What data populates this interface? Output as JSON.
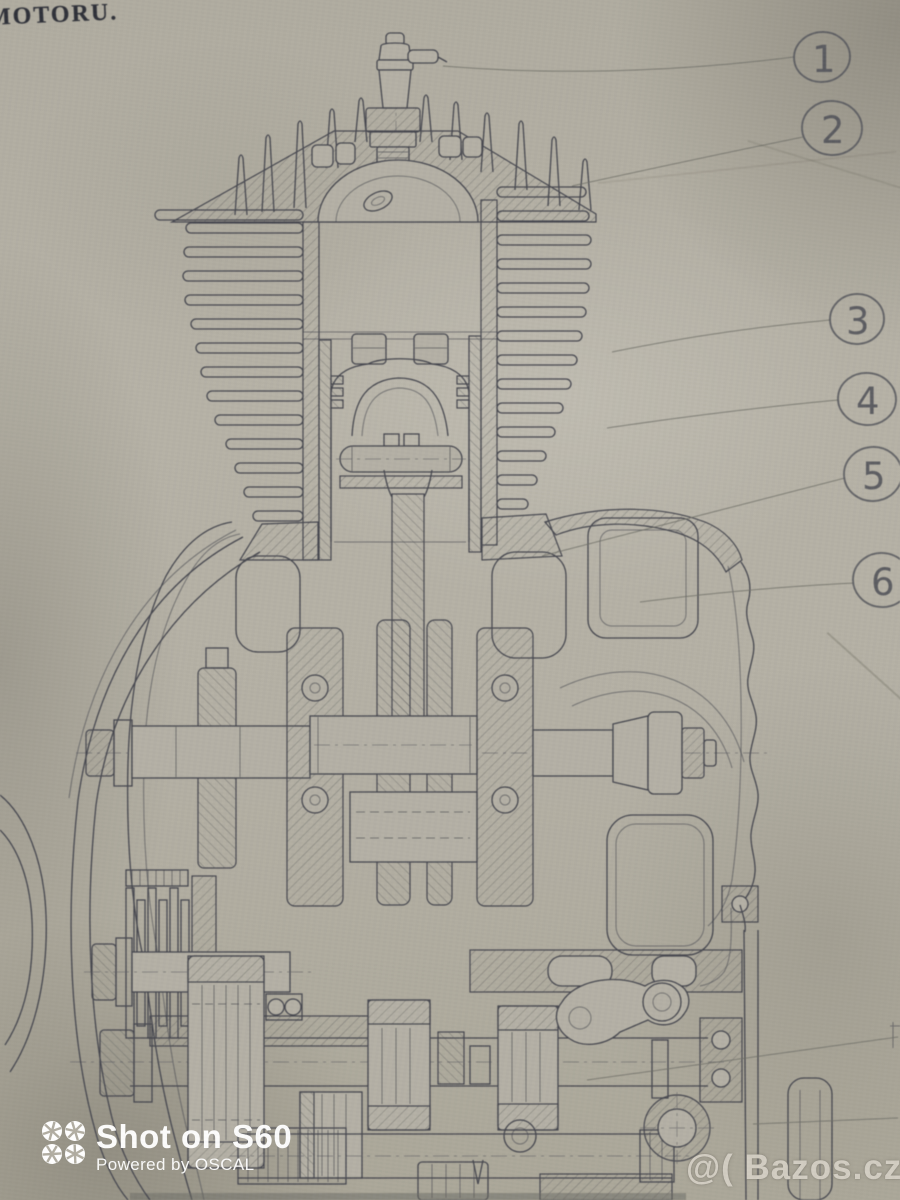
{
  "title": "MOTORU.",
  "callouts": [
    "1",
    "2",
    "3",
    "4",
    "5",
    "6"
  ],
  "camera_watermark": {
    "line1": "Shot on S60",
    "line2": "Powered by OSCAL",
    "icon": "aperture-grid-icon"
  },
  "site_watermark": {
    "prefix": "@(",
    "text": "Bazos.cz"
  },
  "figure": {
    "type": "engine-cross-section-drawing",
    "callout_style": "hand-drawn pencil circles with leader lines"
  },
  "colors": {
    "paper": "#b2aea2",
    "ink": "#45464e",
    "pencil": "#55565c",
    "camera_watermark": "#ffffff",
    "site_watermark": "#e2ddd2"
  }
}
